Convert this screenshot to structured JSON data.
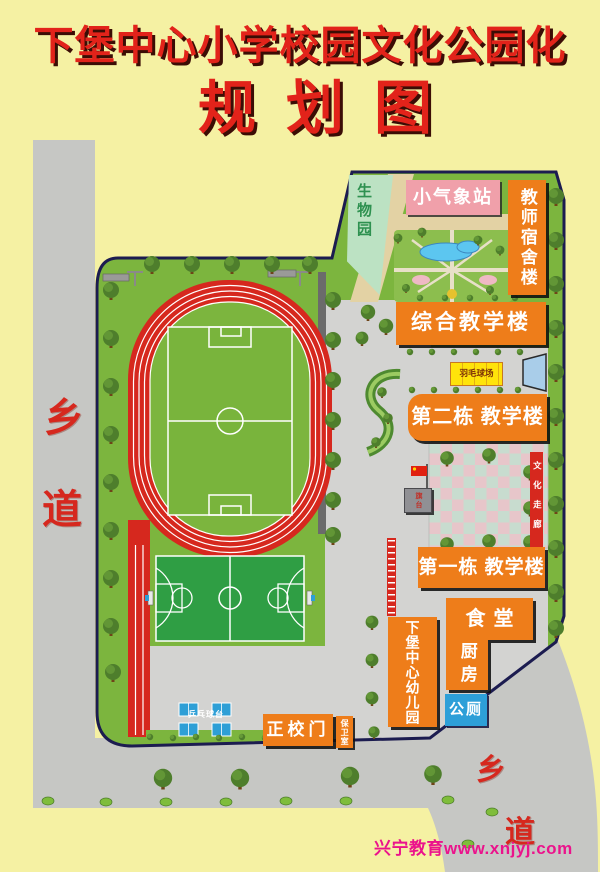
{
  "title": {
    "line1": "下堡中心小学校园文化公园化",
    "line2": "规划图"
  },
  "roads": {
    "left": [
      "乡",
      "道"
    ],
    "bottom_right": [
      "乡",
      "道"
    ]
  },
  "campus": {
    "biology_garden": "生物园",
    "weather_station": "小气象站",
    "teacher_dormitory": "教师宿舍楼",
    "comprehensive_teaching_building": "综合教学楼",
    "badminton_court": "羽毛球场",
    "teaching_building_no2": "第二栋 教学楼",
    "culture_corridor": "文化走廊",
    "flag_platform": "旗台",
    "teaching_building_no1": "第一栋 教学楼",
    "canteen": "食堂",
    "kitchen": "厨房",
    "kindergarten": "下堡中心幼儿园",
    "public_toilet": "公厕",
    "main_gate": "正校门",
    "security_room": "保卫室",
    "table_tennis": "乒乓球台"
  },
  "watermark": "兴宁教育www.xnjyj.com",
  "colors": {
    "background": "#F5F1A3",
    "title_red": "#E2231A",
    "building_orange": "#EE7D1A",
    "track_red": "#D6281E",
    "grass_green": "#7CB53E",
    "court_green": "#2F9E44",
    "road_gray": "#C6C7C4",
    "boundary_navy": "#1C1C50",
    "pool_blue": "#5CC6F0",
    "toilet_blue": "#2D9FD8",
    "weather_pink": "#F0A0AA",
    "biology_green": "#BCE2C3",
    "badminton_yellow": "#FFE30A",
    "watermark_magenta": "#EB138C"
  }
}
